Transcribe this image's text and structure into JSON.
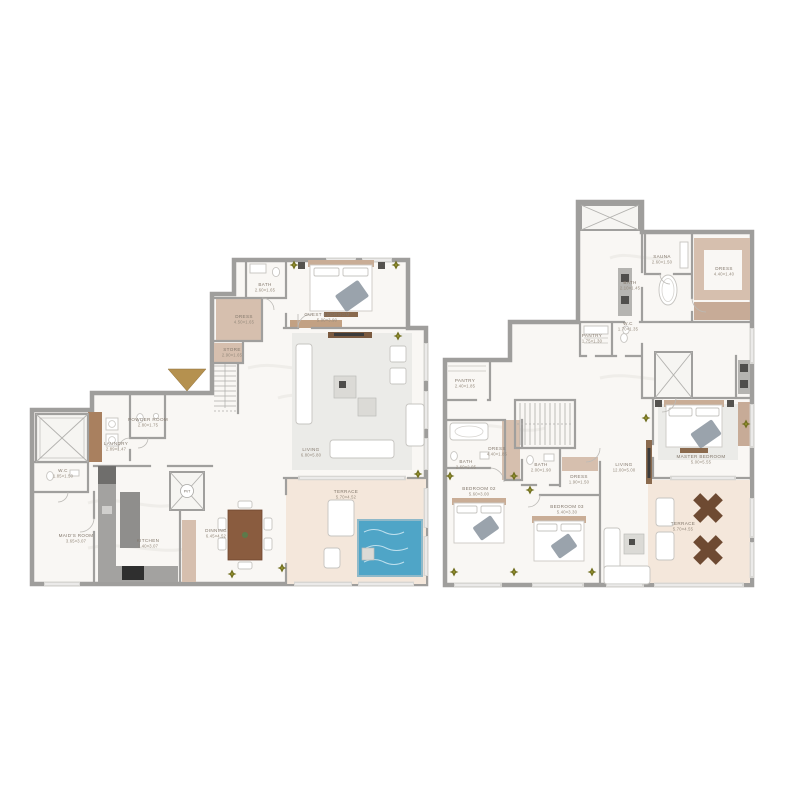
{
  "colors": {
    "wall": "#9f9e9c",
    "floor": "#f9f7f4",
    "tan_room": "#d6bfae",
    "wood": "#a9805f",
    "wood_dark": "#8a5c3f",
    "terrace": "#f4e7db",
    "rug": "#ebebe8",
    "pool": "#4fa5c7",
    "entry_arrow_gold": "#b5914f",
    "plant_olive": "#716f20",
    "label_text": "#83786c"
  },
  "left_plan": {
    "lift_label": "PVT",
    "rooms": {
      "bath": {
        "name": "BATH",
        "dims": "2.60×1.65"
      },
      "dress": {
        "name": "DRESS",
        "dims": "4.50×1.65"
      },
      "guest_bedroom": {
        "name": "GUEST BEDROOM",
        "dims": "5.00×3.90"
      },
      "store": {
        "name": "STORE",
        "dims": "2.90×1.65"
      },
      "powder_room": {
        "name": "POWDER ROOM",
        "dims": "2.80×1.75"
      },
      "laundry": {
        "name": "LAUNDRY",
        "dims": "2.89×1.47"
      },
      "wc": {
        "name": "W.C",
        "dims": "1.85×1.50"
      },
      "maids_room": {
        "name": "MAID'S ROOM",
        "dims": "3.65×3.07"
      },
      "kitchen": {
        "name": "KITCHEN",
        "dims": "7.40×3.07"
      },
      "dining": {
        "name": "DINNING",
        "dims": "6.45×4.52"
      },
      "living": {
        "name": "LIVING",
        "dims": "6.80×5.80"
      },
      "terrace": {
        "name": "TERRACE",
        "dims": "5.70×4.52"
      }
    }
  },
  "right_plan": {
    "rooms": {
      "sauna": {
        "name": "SAUNA",
        "dims": "2.60×1.50"
      },
      "dress_top": {
        "name": "DRESS",
        "dims": "4.40×1.40"
      },
      "bath_top": {
        "name": "BATH",
        "dims": "2.10×1.45"
      },
      "pantry_small": {
        "name": "PANTRY",
        "dims": "1.75×1.30"
      },
      "wc": {
        "name": "W.C",
        "dims": "1.70×1.35"
      },
      "pantry": {
        "name": "PANTRY",
        "dims": "2.40×1.85"
      },
      "dress_mid": {
        "name": "DRESS",
        "dims": "4.40×1.85"
      },
      "bath_left": {
        "name": "BATH",
        "dims": "2.60×2.05"
      },
      "bath_mid": {
        "name": "BATH",
        "dims": "2.00×1.90"
      },
      "dress_small": {
        "name": "DRESS",
        "dims": "1.90×1.50"
      },
      "bedroom_02": {
        "name": "BEDROOM 02",
        "dims": "5.60×3.00"
      },
      "bedroom_03": {
        "name": "BEDROOM 03",
        "dims": "5.40×3.30"
      },
      "living": {
        "name": "LIVING",
        "dims": "12.00×5.00"
      },
      "master_bedroom": {
        "name": "MASTER BEDROOM",
        "dims": "5.00×5.55"
      },
      "terrace": {
        "name": "TERRACE",
        "dims": "5.70×4.55"
      }
    }
  }
}
